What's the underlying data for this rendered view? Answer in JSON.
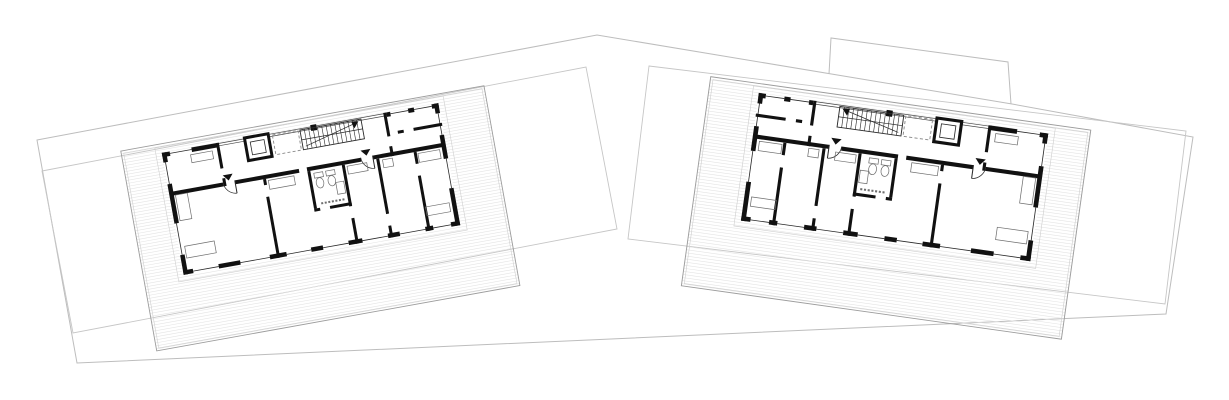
{
  "canvas": {
    "width": 1229,
    "height": 400,
    "background": "#ffffff"
  },
  "drawing_type": "architectural-site-floor-plan",
  "colors": {
    "wall": "#111111",
    "thin_line": "#2a2a2a",
    "site_line": "#bdbdbd",
    "parcel_line": "#c6c6c6",
    "deck_board": "#e4e4e4",
    "deck_border": "#9c9c9c",
    "deck_inner": "#cfcfcf",
    "void_dash": "#8a8a8a",
    "fixture_line": "#6e6e6e",
    "glazing_line": "#444444"
  },
  "site": {
    "outer_boundary": [
      [
        37,
        140
      ],
      [
        597,
        35
      ],
      [
        1012,
        104
      ],
      [
        1193,
        137
      ],
      [
        1166,
        314
      ],
      [
        77,
        363
      ]
    ],
    "tab_polyline": [
      [
        829,
        74
      ],
      [
        831,
        38
      ],
      [
        1008,
        62
      ],
      [
        1011,
        104
      ]
    ],
    "parcels": [
      {
        "name": "west-parcel",
        "points": [
          [
            42,
            171
          ],
          [
            586,
            67
          ],
          [
            617,
            229
          ],
          [
            73,
            333
          ]
        ]
      },
      {
        "name": "east-parcel",
        "points": [
          [
            649,
            66
          ],
          [
            1186,
            131
          ],
          [
            1165,
            304
          ],
          [
            628,
            239
          ]
        ]
      }
    ]
  },
  "buildings": [
    {
      "name": "west-building",
      "cx": 311,
      "cy": 189,
      "rotation": -10.2,
      "scale": 1.0,
      "mirror": false
    },
    {
      "name": "east-building",
      "cx": 894.6,
      "cy": 177.1,
      "rotation": 8.0,
      "scale": 1.04,
      "mirror": true
    }
  ],
  "plan": {
    "width": 281,
    "height": 124,
    "deck": {
      "x": -40,
      "y": -9,
      "w": 369,
      "h": 203,
      "board_spacing": 3
    },
    "building_offset_outline": [
      -6,
      -6,
      293,
      136
    ],
    "exterior_wall_rects": [
      [
        0,
        0,
        8,
        4.5
      ],
      [
        30,
        0,
        26,
        4.5
      ],
      [
        228,
        0,
        4,
        4.5
      ],
      [
        250,
        0,
        6,
        4.5
      ],
      [
        274,
        0,
        7,
        4.5
      ],
      [
        0,
        119.5,
        10,
        4.5
      ],
      [
        36,
        119.5,
        22,
        4.5
      ],
      [
        88,
        119.5,
        17,
        4.5
      ],
      [
        130,
        119.5,
        12,
        4.5
      ],
      [
        168,
        119.5,
        14,
        4.5
      ],
      [
        208,
        119.5,
        12,
        4.5
      ],
      [
        246,
        119.5,
        8,
        4.5
      ],
      [
        272,
        119.5,
        9,
        4.5
      ],
      [
        0,
        0,
        4.5,
        10
      ],
      [
        0,
        32,
        4.5,
        40
      ],
      [
        0,
        104,
        4.5,
        20
      ],
      [
        276.5,
        0,
        4.5,
        10
      ],
      [
        276.5,
        32,
        4.5,
        24
      ],
      [
        276.5,
        86,
        4.5,
        38
      ]
    ],
    "window_sill_lines": [
      [
        8,
        2,
        30,
        2
      ],
      [
        232,
        2,
        250,
        2
      ],
      [
        256,
        2,
        274,
        2
      ],
      [
        10,
        122,
        36,
        122
      ],
      [
        58,
        122,
        88,
        122
      ],
      [
        105,
        122,
        130,
        122
      ],
      [
        142,
        122,
        168,
        122
      ],
      [
        182,
        122,
        208,
        122
      ],
      [
        220,
        122,
        246,
        122
      ],
      [
        254,
        122,
        272,
        122
      ],
      [
        2,
        10,
        2,
        32
      ],
      [
        2,
        72,
        2,
        104
      ],
      [
        279,
        10,
        279,
        32
      ],
      [
        279,
        56,
        279,
        86
      ]
    ],
    "glazing": {
      "x1": 56,
      "x2": 228,
      "y1": 0.8,
      "y2": 3.2
    },
    "column_rect": [
      151,
      -1,
      6,
      6
    ],
    "interior_wall_rects": [
      [
        4,
        40,
        51,
        4
      ],
      [
        67,
        40,
        65,
        4
      ],
      [
        140,
        40,
        55,
        4
      ],
      [
        207,
        40,
        70,
        4
      ],
      [
        55,
        0,
        3,
        26
      ],
      [
        55,
        36,
        3,
        8
      ],
      [
        225,
        0,
        3,
        24
      ],
      [
        225,
        34,
        3,
        10
      ],
      [
        236,
        20,
        6,
        3
      ],
      [
        252,
        20,
        29,
        3
      ],
      [
        95,
        44,
        3,
        6
      ],
      [
        95,
        62,
        3,
        62
      ],
      [
        140,
        44,
        3,
        38
      ],
      [
        175,
        44,
        3,
        42
      ],
      [
        175,
        98,
        3,
        26
      ],
      [
        140,
        82,
        6,
        3
      ],
      [
        156,
        82,
        22,
        3
      ],
      [
        210,
        44,
        3,
        56
      ],
      [
        210,
        112,
        3,
        12
      ],
      [
        248,
        44,
        3,
        12
      ],
      [
        248,
        68,
        3,
        56
      ]
    ],
    "entry_doors": [
      {
        "hinge": [
          67,
          40
        ],
        "leaf_end": [
          67,
          53
        ],
        "arc_from": [
          55,
          40
        ],
        "radius": 13
      },
      {
        "hinge": [
          207,
          40
        ],
        "leaf_end": [
          207,
          53
        ],
        "arc_from": [
          195,
          40
        ],
        "radius": 13
      }
    ],
    "entry_markers": [
      [
        61,
        33
      ],
      [
        201,
        33
      ]
    ],
    "stair": {
      "x": 140,
      "y": 2,
      "w": 62,
      "h": 20,
      "treads": 13
    },
    "void_rect": [
      112,
      2,
      26,
      20
    ],
    "elevator": {
      "outer": [
        84,
        0,
        24,
        23
      ],
      "inner": [
        89,
        5,
        14,
        13
      ]
    },
    "furniture_rects": [
      [
        100,
        46,
        26,
        9
      ],
      [
        180,
        46,
        20,
        8
      ],
      [
        252,
        46,
        22,
        9
      ],
      [
        6,
        44,
        12,
        26
      ],
      [
        6,
        96,
        30,
        12
      ],
      [
        28,
        7,
        22,
        8
      ],
      [
        216,
        46,
        10,
        8
      ],
      [
        250,
        100,
        24,
        9
      ]
    ],
    "wc_fixtures": [
      [
        146,
        47
      ],
      [
        158,
        47
      ]
    ],
    "sink_rect": [
      166,
      60,
      8,
      12
    ],
    "utility_dash_line": [
      148,
      78,
      172,
      78
    ]
  }
}
